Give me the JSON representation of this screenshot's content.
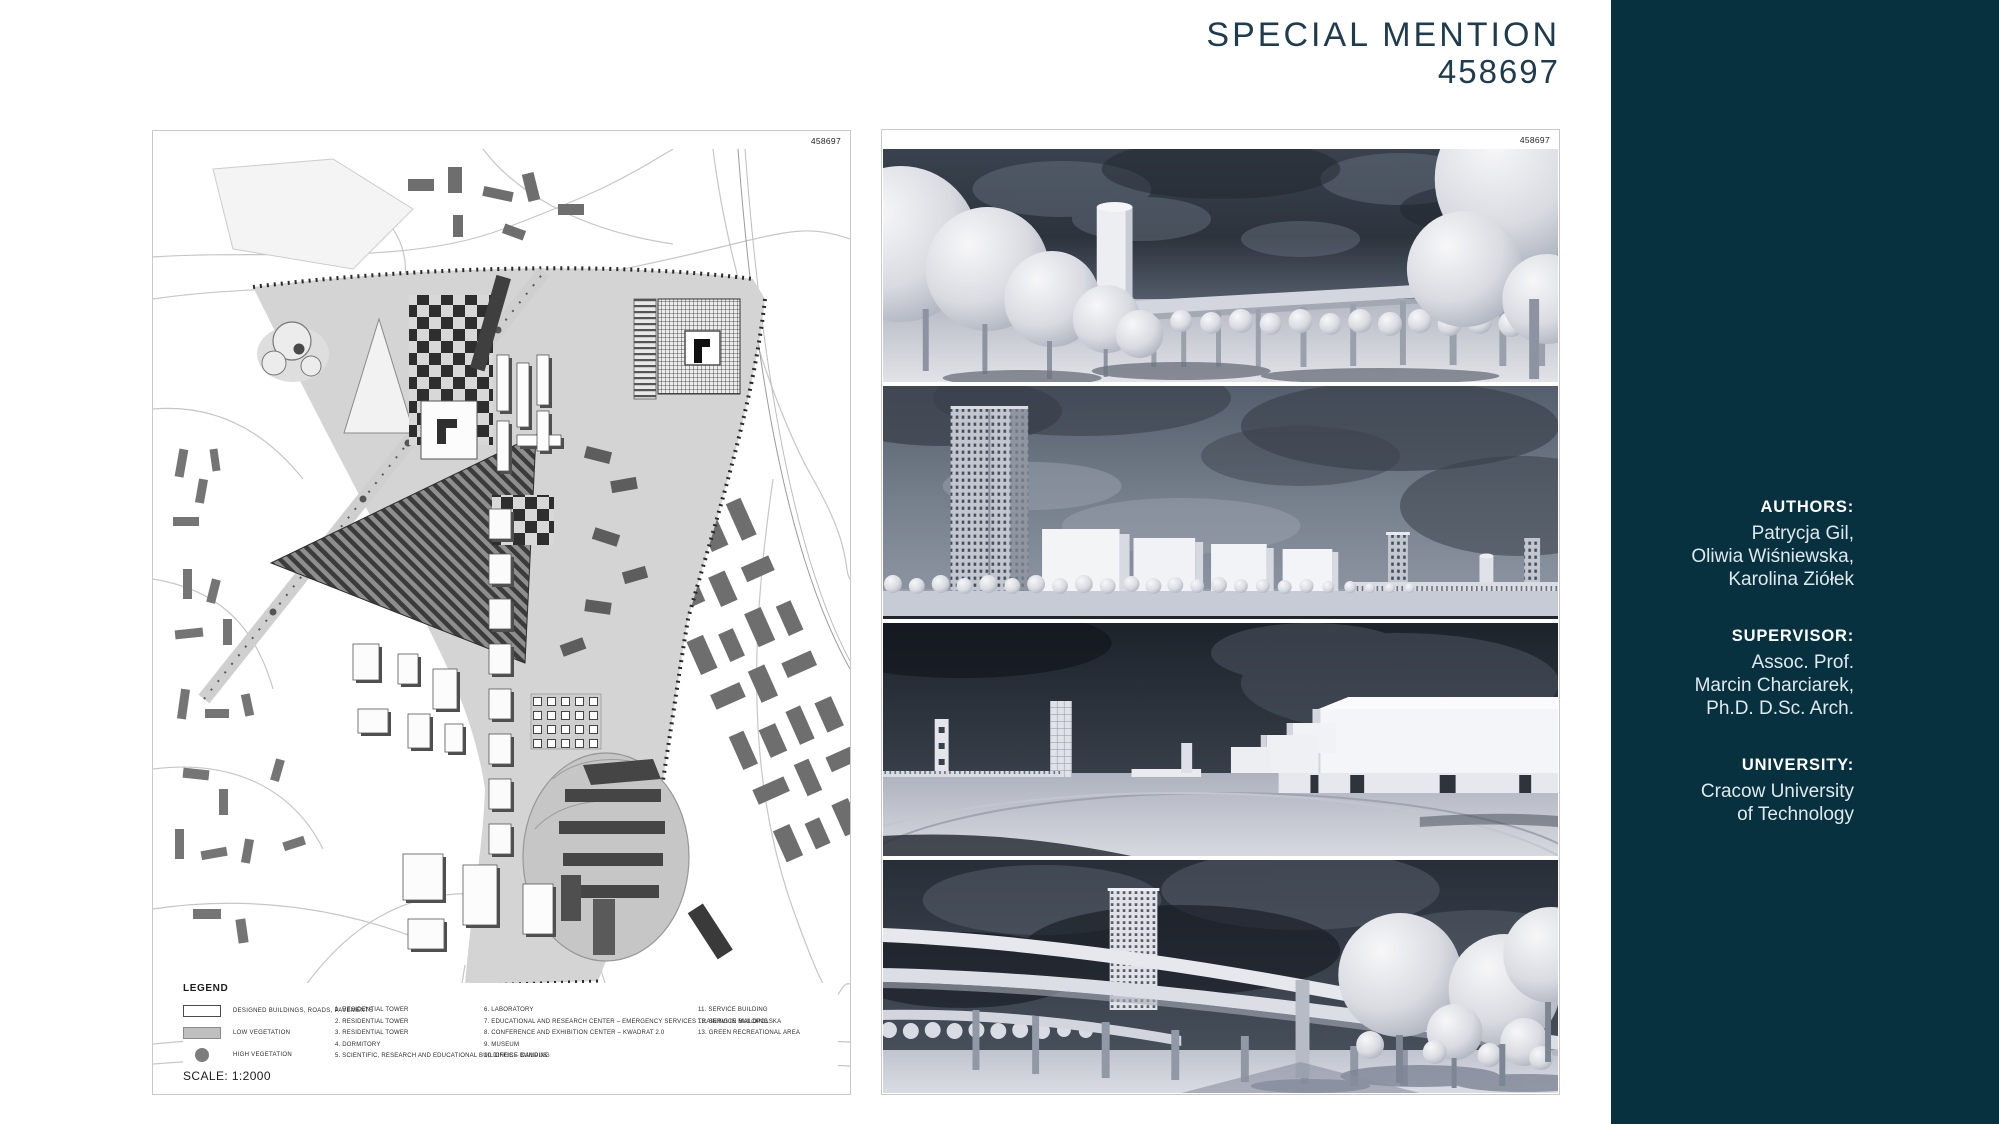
{
  "page": {
    "background": "#ffffff",
    "accent_dark": "#07313f",
    "title_color": "#1e3c4e"
  },
  "header": {
    "award": "SPECIAL MENTION",
    "entry_number": "458697"
  },
  "boards": {
    "left": {
      "board_number": "458697",
      "legend": {
        "title": "LEGEND",
        "swatches": [
          {
            "type": "white-rect",
            "label": "DESIGNED BUILDINGS, ROADS, PAVEMENTS"
          },
          {
            "type": "gray-rect",
            "label": "LOW VEGETATION"
          },
          {
            "type": "gray-circle",
            "label": "HIGH VEGETATION"
          }
        ],
        "items_col1": [
          "1. RESIDENTIAL TOWER",
          "2. RESIDENTIAL TOWER",
          "3. RESIDENTIAL TOWER",
          "4. DORMITORY",
          "5. SCIENTIFIC, RESEARCH AND EDUCATIONAL BUILDINGS – CAMPUS"
        ],
        "items_col2": [
          "6. LABORATORY",
          "7. EDUCATIONAL AND RESEARCH CENTER – EMERGENCY SERVICES TRAINING IN MALOPOLSKA",
          "8. CONFERENCE AND EXHIBITION CENTER – KWADRAT 2.0",
          "9. MUSEUM",
          "10. OFFICE BUILDING"
        ],
        "items_col3": [
          "11. SERVICE BUILDING",
          "12. SERVICE BUILDING",
          "13. GREEN RECREATIONAL AREA"
        ]
      },
      "scale": "SCALE: 1:2000"
    },
    "right": {
      "board_number": "458697"
    }
  },
  "sidebar": {
    "background": "#07313f",
    "sections": [
      {
        "label": "AUTHORS:",
        "lines": [
          "Patrycja Gil,",
          "Oliwia Wiśniewska,",
          "Karolina Ziółek"
        ]
      },
      {
        "label": "SUPERVISOR:",
        "lines": [
          "Assoc. Prof.",
          "Marcin Charciarek,",
          "Ph.D. D.Sc. Arch."
        ]
      },
      {
        "label": "UNIVERSITY:",
        "lines": [
          "Cracow University",
          "of Technology"
        ]
      }
    ]
  }
}
